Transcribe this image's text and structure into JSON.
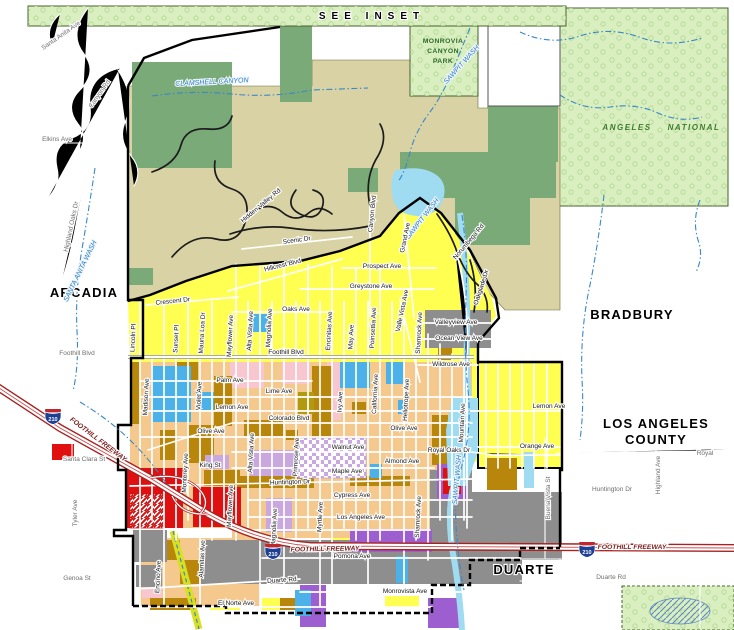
{
  "map": {
    "colors": {
      "lightgreen": "#d9efbf",
      "treeline": "#b2d694",
      "dkgreen": "#79aa77",
      "khaki": "#d9d2a4",
      "yellow": "#ffff52",
      "peach": "#f5c88e",
      "brown": "#b8860b",
      "olive": "#b09a10",
      "gray": "#8e8e8e",
      "red": "#e01010",
      "pink": "#f7c6ce",
      "purple": "#9d5fd0",
      "lavender": "#c9a8e0",
      "blue": "#4cb1e8",
      "palecyan": "#9fdcf2",
      "water": "#3a87c8",
      "forestline": "#46602e",
      "freeway": "#a82222",
      "channel": "#d9e021"
    },
    "styles": {
      "city": {
        "fs": 13,
        "c": "#000000",
        "b": true,
        "ls": 1.2,
        "halo": "#ffffff"
      },
      "inset": {
        "fs": 10,
        "c": "#000000",
        "b": true,
        "ls": 6,
        "halo": "#ffffff"
      },
      "forest": {
        "fs": 8,
        "c": "#3f7a2f",
        "b": true,
        "i": true,
        "ls": 1.5
      },
      "park": {
        "fs": 6.8,
        "c": "#2e6b2e",
        "b": true,
        "ls": 0.4
      },
      "water": {
        "fs": 7,
        "c": "#2e7bbf",
        "i": true,
        "halo": "#eef7fd"
      },
      "road": {
        "fs": 6.5,
        "c": "#141414",
        "halo": "#ffffff"
      },
      "roadg": {
        "fs": 6.5,
        "c": "#6e6e6e",
        "halo": "#ffffff"
      },
      "fwy": {
        "fs": 6.8,
        "c": "#7a1c1c",
        "b": true,
        "i": true,
        "halo": "#ffffff"
      }
    },
    "labels": [
      {
        "t": "SEE INSET",
        "x": 372,
        "y": 19,
        "k": "inset"
      },
      {
        "t": "MONROVIA",
        "x": 443,
        "y": 43,
        "k": "park"
      },
      {
        "t": "CANYON",
        "x": 443,
        "y": 53,
        "k": "park"
      },
      {
        "t": "PARK",
        "x": 443,
        "y": 63,
        "k": "park"
      },
      {
        "t": "ANGELES",
        "x": 627,
        "y": 130,
        "k": "forest"
      },
      {
        "t": "NATIONAL",
        "x": 694,
        "y": 130,
        "k": "forest"
      },
      {
        "t": "ARCADIA",
        "x": 84,
        "y": 297,
        "k": "city"
      },
      {
        "t": "BRADBURY",
        "x": 632,
        "y": 319,
        "k": "city"
      },
      {
        "t": "LOS ANGELES",
        "x": 656,
        "y": 428,
        "k": "city"
      },
      {
        "t": "COUNTY",
        "x": 656,
        "y": 444,
        "k": "city"
      },
      {
        "t": "DUARTE",
        "x": 524,
        "y": 574,
        "k": "city"
      },
      {
        "t": "SAWPIT WASH",
        "x": 463,
        "y": 66,
        "k": "water",
        "r": -48
      },
      {
        "t": "CLAMSHELL CANYON",
        "x": 212,
        "y": 84,
        "k": "water",
        "r": -3
      },
      {
        "t": "SANTA ANITA WASH",
        "x": 82,
        "y": 272,
        "k": "water",
        "r": -64
      },
      {
        "t": "SAWPIT WASH",
        "x": 424,
        "y": 220,
        "k": "water",
        "r": -52
      },
      {
        "t": "SAWPIT WASH",
        "x": 459,
        "y": 480,
        "k": "water",
        "r": -85
      },
      {
        "t": "Santa Anita Ave",
        "x": 62,
        "y": 37,
        "k": "roadg",
        "r": -35
      },
      {
        "t": "Canyon Rd",
        "x": 101,
        "y": 95,
        "k": "roadg",
        "r": -55
      },
      {
        "t": "Elkins Ave",
        "x": 57,
        "y": 141,
        "k": "roadg"
      },
      {
        "t": "Highland Oaks Dr",
        "x": 73,
        "y": 227,
        "k": "roadg",
        "r": -78
      },
      {
        "t": "Foothill Blvd",
        "x": 77,
        "y": 355,
        "k": "roadg"
      },
      {
        "t": "Santa Clara St",
        "x": 84,
        "y": 461,
        "k": "roadg"
      },
      {
        "t": "Tyler Ave",
        "x": 77,
        "y": 513,
        "k": "roadg",
        "r": -90
      },
      {
        "t": "Genoa St",
        "x": 77,
        "y": 580,
        "k": "roadg"
      },
      {
        "t": "Huntington Dr",
        "x": 612,
        "y": 491,
        "k": "roadg"
      },
      {
        "t": "Highland Ave",
        "x": 660,
        "y": 475,
        "k": "roadg",
        "r": -90
      },
      {
        "t": "Buena Vista St",
        "x": 550,
        "y": 498,
        "k": "roadg",
        "r": -90
      },
      {
        "t": "Duarte Rd",
        "x": 611,
        "y": 579,
        "k": "roadg"
      },
      {
        "t": "Royal",
        "x": 705,
        "y": 455,
        "k": "roadg"
      },
      {
        "t": "Crescent Dr",
        "x": 173,
        "y": 303,
        "k": "road",
        "r": -6
      },
      {
        "t": "Hidden Valley Rd",
        "x": 262,
        "y": 207,
        "k": "road",
        "r": -40
      },
      {
        "t": "Scenic Dr",
        "x": 297,
        "y": 242,
        "k": "road",
        "r": -8
      },
      {
        "t": "Hillcrest Blvd",
        "x": 283,
        "y": 267,
        "k": "road",
        "r": -14
      },
      {
        "t": "Canyon Blvd",
        "x": 374,
        "y": 214,
        "k": "road",
        "r": -84
      },
      {
        "t": "Norumbega Rd",
        "x": 470,
        "y": 243,
        "k": "road",
        "r": -50
      },
      {
        "t": "Oakglade Dr",
        "x": 483,
        "y": 288,
        "k": "road",
        "r": -72
      },
      {
        "t": "Grand Ave",
        "x": 407,
        "y": 238,
        "k": "road",
        "r": -78
      },
      {
        "t": "Valle Vista Ave",
        "x": 404,
        "y": 311,
        "k": "road",
        "r": -78
      },
      {
        "t": "Prospect Ave",
        "x": 382,
        "y": 268,
        "k": "road"
      },
      {
        "t": "Greystone Ave",
        "x": 371,
        "y": 288,
        "k": "road"
      },
      {
        "t": "Oaks Ave",
        "x": 296,
        "y": 311,
        "k": "road"
      },
      {
        "t": "Lincoln Pl",
        "x": 135,
        "y": 338,
        "k": "road",
        "r": -87
      },
      {
        "t": "Sunset Pl",
        "x": 178,
        "y": 339,
        "k": "road",
        "r": -87
      },
      {
        "t": "Mauna Loa Dr",
        "x": 204,
        "y": 333,
        "k": "road",
        "r": -87
      },
      {
        "t": "Mayflower Ave",
        "x": 232,
        "y": 336,
        "k": "road",
        "r": -87
      },
      {
        "t": "Alta Vista Ave",
        "x": 252,
        "y": 331,
        "k": "road",
        "r": -87
      },
      {
        "t": "Magnolia Ave",
        "x": 271,
        "y": 328,
        "k": "road",
        "r": -87
      },
      {
        "t": "Encinitas Ave",
        "x": 331,
        "y": 331,
        "k": "road",
        "r": -87
      },
      {
        "t": "May Ave",
        "x": 353,
        "y": 337,
        "k": "road",
        "r": -87
      },
      {
        "t": "Poinsettia Ave",
        "x": 375,
        "y": 328,
        "k": "road",
        "r": -87
      },
      {
        "t": "Foothill Blvd",
        "x": 286,
        "y": 354,
        "k": "road"
      },
      {
        "t": "Valleyview Ave",
        "x": 456,
        "y": 324,
        "k": "road"
      },
      {
        "t": "Ocean View Ave",
        "x": 459,
        "y": 340,
        "k": "road"
      },
      {
        "t": "Wildrose Ave",
        "x": 451,
        "y": 366,
        "k": "road"
      },
      {
        "t": "Shamrock Ave",
        "x": 421,
        "y": 333,
        "k": "road",
        "r": -87
      },
      {
        "t": "Mountain Ave",
        "x": 464,
        "y": 423,
        "k": "road",
        "r": -87
      },
      {
        "t": "Lemon Ave",
        "x": 549,
        "y": 408,
        "k": "road"
      },
      {
        "t": "Orange Ave",
        "x": 537,
        "y": 448,
        "k": "road"
      },
      {
        "t": "Royal Oaks Dr",
        "x": 449,
        "y": 452,
        "k": "road"
      },
      {
        "t": "Madison Ave",
        "x": 148,
        "y": 397,
        "k": "road",
        "r": -87
      },
      {
        "t": "Violet Ave",
        "x": 201,
        "y": 396,
        "k": "road",
        "r": -87
      },
      {
        "t": "Palm Ave",
        "x": 230,
        "y": 382,
        "k": "road"
      },
      {
        "t": "Lime Ave",
        "x": 279,
        "y": 393,
        "k": "road"
      },
      {
        "t": "Lemon Ave",
        "x": 232,
        "y": 409,
        "k": "road"
      },
      {
        "t": "Colorado Blvd",
        "x": 289,
        "y": 420,
        "k": "road"
      },
      {
        "t": "Olive Ave",
        "x": 211,
        "y": 433,
        "k": "road"
      },
      {
        "t": "Olive Ave",
        "x": 404,
        "y": 430,
        "k": "road"
      },
      {
        "t": "King St",
        "x": 210,
        "y": 467,
        "k": "road"
      },
      {
        "t": "Monterey Ave",
        "x": 187,
        "y": 473,
        "k": "road",
        "r": -87
      },
      {
        "t": "Mayflower Ave",
        "x": 232,
        "y": 506,
        "k": "road",
        "r": -87
      },
      {
        "t": "Magnolia Ave",
        "x": 276,
        "y": 528,
        "k": "road",
        "r": -87
      },
      {
        "t": "Primrose Ave",
        "x": 298,
        "y": 457,
        "k": "road",
        "r": -87
      },
      {
        "t": "Myrtle Ave",
        "x": 322,
        "y": 517,
        "k": "road",
        "r": -87
      },
      {
        "t": "Ivy Ave",
        "x": 342,
        "y": 402,
        "k": "road",
        "r": -87
      },
      {
        "t": "California Ave",
        "x": 377,
        "y": 394,
        "k": "road",
        "r": -87
      },
      {
        "t": "Heliotrope Ave",
        "x": 408,
        "y": 400,
        "k": "road",
        "r": -87
      },
      {
        "t": "Shamrock Ave",
        "x": 420,
        "y": 517,
        "k": "road",
        "r": -87
      },
      {
        "t": "Alta Vista Ave",
        "x": 253,
        "y": 453,
        "k": "road",
        "r": -87
      },
      {
        "t": "Walnut Ave",
        "x": 348,
        "y": 449,
        "k": "road"
      },
      {
        "t": "Maple Ave",
        "x": 347,
        "y": 473,
        "k": "road"
      },
      {
        "t": "Almond Ave",
        "x": 402,
        "y": 463,
        "k": "road"
      },
      {
        "t": "Huntington Dr",
        "x": 290,
        "y": 484,
        "k": "road",
        "r": -2
      },
      {
        "t": "Cypress Ave",
        "x": 352,
        "y": 497,
        "k": "road"
      },
      {
        "t": "Los Angeles Ave",
        "x": 361,
        "y": 519,
        "k": "road"
      },
      {
        "t": "Pomona Ave",
        "x": 352,
        "y": 558,
        "k": "road"
      },
      {
        "t": "Duarte Rd",
        "x": 282,
        "y": 582,
        "k": "road",
        "r": -4
      },
      {
        "t": "Monrovista Ave",
        "x": 405,
        "y": 593,
        "k": "road"
      },
      {
        "t": "El Norte Ave",
        "x": 236,
        "y": 605,
        "k": "road"
      },
      {
        "t": "Encino Ave",
        "x": 160,
        "y": 577,
        "k": "road",
        "r": -87
      },
      {
        "t": "Alamitas Ave",
        "x": 204,
        "y": 559,
        "k": "road",
        "r": -87
      },
      {
        "t": "FOOTHILL FREEWAY",
        "x": 97,
        "y": 441,
        "k": "fwy",
        "r": 37
      },
      {
        "t": "FOOTHILL FREEWAY",
        "x": 325,
        "y": 551,
        "k": "fwy",
        "r": -1
      },
      {
        "t": "FOOTHILL FREEWAY",
        "x": 632,
        "y": 549,
        "k": "fwy"
      }
    ],
    "shields": [
      {
        "label": "210",
        "x": 53,
        "y": 416
      },
      {
        "label": "210",
        "x": 273,
        "y": 551
      },
      {
        "label": "210",
        "x": 587,
        "y": 549
      }
    ]
  }
}
